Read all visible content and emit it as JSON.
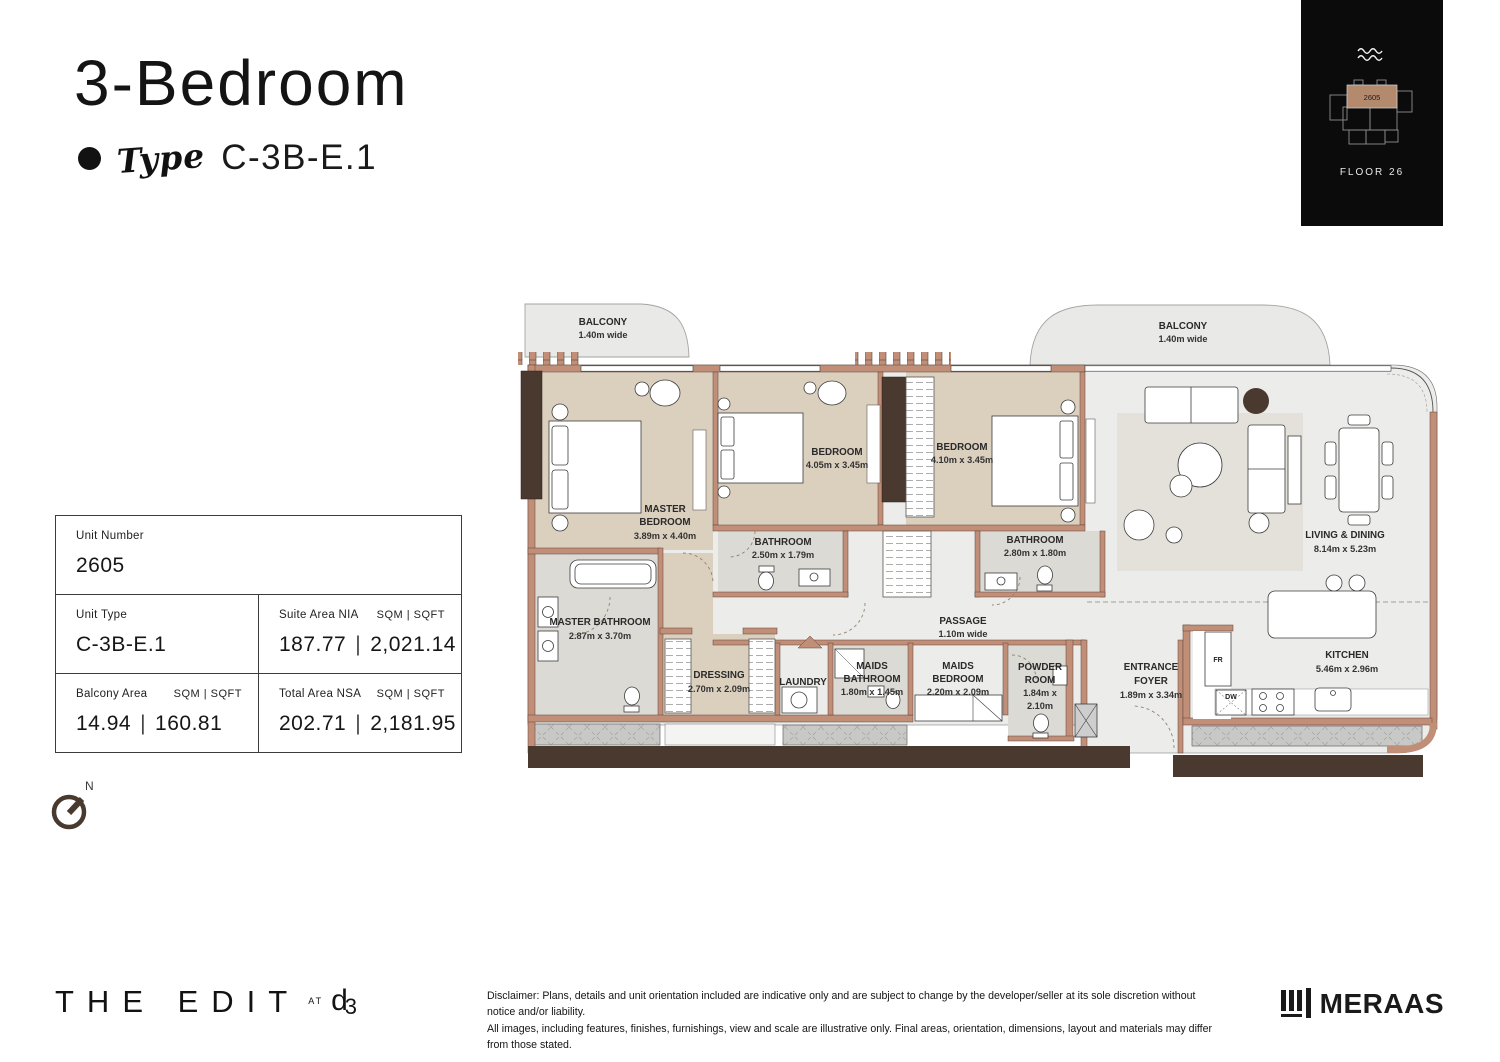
{
  "header": {
    "title": "3-Bedroom",
    "type_label": "Type",
    "type_value": "C-3B-E.1"
  },
  "keyplan": {
    "unit_number": "2605",
    "floor_label": "FLOOR 26"
  },
  "info_table": {
    "unit_number": {
      "label": "Unit Number",
      "value": "2605"
    },
    "unit_type": {
      "label": "Unit Type",
      "value": "C-3B-E.1"
    },
    "suite_area": {
      "label": "Suite Area NIA",
      "units": "SQM  |  SQFT",
      "sqm": "187.77",
      "sep": "|",
      "sqft": "2,021.14"
    },
    "balcony_area": {
      "label": "Balcony Area",
      "units": "SQM  |  SQFT",
      "sqm": "14.94",
      "sep": "|",
      "sqft": "160.81"
    },
    "total_area": {
      "label": "Total Area NSA",
      "units": "SQM  |  SQFT",
      "sqm": "202.71",
      "sep": "|",
      "sqft": "2,181.95"
    }
  },
  "compass": {
    "north_label": "N"
  },
  "floorplan": {
    "rooms": [
      {
        "id": "balcony-left",
        "lines": [
          "BALCONY",
          "1.40m wide"
        ]
      },
      {
        "id": "balcony-right",
        "lines": [
          "BALCONY",
          "1.40m wide"
        ]
      },
      {
        "id": "master-bedroom",
        "lines": [
          "MASTER",
          "BEDROOM",
          "3.89m x 4.40m"
        ]
      },
      {
        "id": "bedroom-2",
        "lines": [
          "BEDROOM",
          "4.05m x 3.45m"
        ]
      },
      {
        "id": "bedroom-3",
        "lines": [
          "BEDROOM",
          "4.10m x 3.45m"
        ]
      },
      {
        "id": "bathroom-1",
        "lines": [
          "BATHROOM",
          "2.50m x 1.79m"
        ]
      },
      {
        "id": "bathroom-2",
        "lines": [
          "BATHROOM",
          "2.80m x 1.80m"
        ]
      },
      {
        "id": "master-bathroom",
        "lines": [
          "MASTER BATHROOM",
          "2.87m x 3.70m"
        ]
      },
      {
        "id": "dressing",
        "lines": [
          "DRESSING",
          "2.70m x 2.09m"
        ]
      },
      {
        "id": "laundry",
        "lines": [
          "LAUNDRY"
        ]
      },
      {
        "id": "maids-bathroom",
        "lines": [
          "MAIDS",
          "BATHROOM",
          "1.80m x 1.45m"
        ]
      },
      {
        "id": "maids-bedroom",
        "lines": [
          "MAIDS",
          "BEDROOM",
          "2.20m x 2.09m"
        ]
      },
      {
        "id": "powder-room",
        "lines": [
          "POWDER",
          "ROOM",
          "1.84m x",
          "2.10m"
        ]
      },
      {
        "id": "entrance-foyer",
        "lines": [
          "ENTRANCE",
          "FOYER",
          "1.89m x 3.34m"
        ]
      },
      {
        "id": "passage",
        "lines": [
          "PASSAGE",
          "1.10m wide"
        ]
      },
      {
        "id": "living-dining",
        "lines": [
          "LIVING & DINING",
          "8.14m x 5.23m"
        ]
      },
      {
        "id": "kitchen",
        "lines": [
          "KITCHEN",
          "5.46m x 2.96m"
        ]
      }
    ],
    "appliances": {
      "fridge_label": "FR",
      "dishwasher_label": "DW"
    }
  },
  "footer": {
    "brand_the_edit": "THE EDIT",
    "brand_at": "AT",
    "brand_d3_d": "d",
    "brand_d3_3": "3",
    "disclaimer_line1": "Disclaimer: Plans, details and unit orientation included are indicative only and are subject to change by the developer/seller at its sole discretion without notice and/or liability.",
    "disclaimer_line2": "All images, including features, finishes, furnishings, view and scale are illustrative only. Final areas, orientation, dimensions, layout and materials may differ from those stated.",
    "developer": "MERAAS"
  },
  "colors": {
    "wall": "#c18f77",
    "bedroom_fill": "#dbcfbe",
    "bath_fill": "#dcdad4",
    "living_fill": "#ececea",
    "dark_wood": "#4a392e",
    "keyplan_unit": "#b48a6e"
  }
}
